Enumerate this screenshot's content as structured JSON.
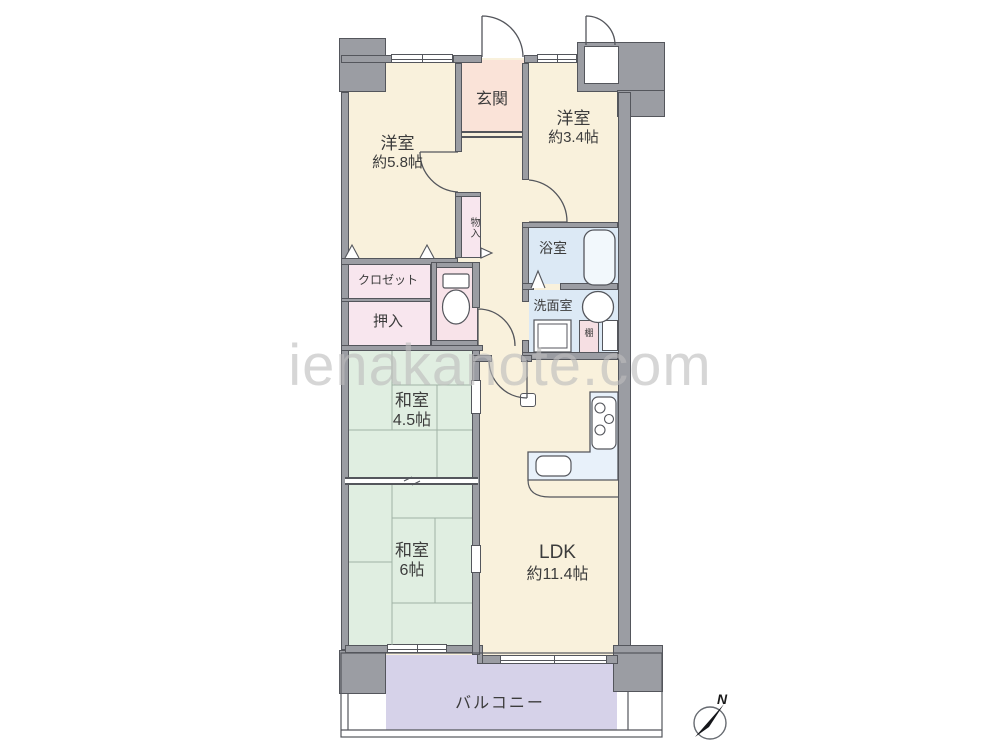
{
  "watermark": {
    "text": "ienakanote.com"
  },
  "compass": {
    "label": "N"
  },
  "colors": {
    "wall_fill": "#9b9da3",
    "wall_edge": "#54565c",
    "room_cream": "#f9f1dc",
    "entrance_pink": "#fae3d8",
    "storage_pink": "#f8e6ee",
    "toilet_pink": "#f8e3e9",
    "wet_area_blue": "#dce9f5",
    "kitchen_counter_blue": "#e8f1fa",
    "tatami_green": "#e0eee1",
    "balcony_lavender": "#d6d2e9",
    "watermark_gray": "#bdbdbd"
  },
  "rooms": {
    "genkan": {
      "label": "玄関"
    },
    "western_58": {
      "label": "洋室",
      "size": "約5.8帖"
    },
    "western_34": {
      "label": "洋室",
      "size": "約3.4帖"
    },
    "monoire": {
      "label": "物入"
    },
    "closet": {
      "label": "クロゼット"
    },
    "oshiire": {
      "label": "押入"
    },
    "bath": {
      "label": "浴室"
    },
    "washroom": {
      "label": "洗面室"
    },
    "shelf": {
      "label": "棚"
    },
    "japanese_45": {
      "label": "和室",
      "size": "4.5帖"
    },
    "japanese_6": {
      "label": "和室",
      "size": "6帖"
    },
    "ldk": {
      "label": "LDK",
      "size": "約11.4帖"
    },
    "balcony": {
      "label": "バルコニー"
    }
  }
}
